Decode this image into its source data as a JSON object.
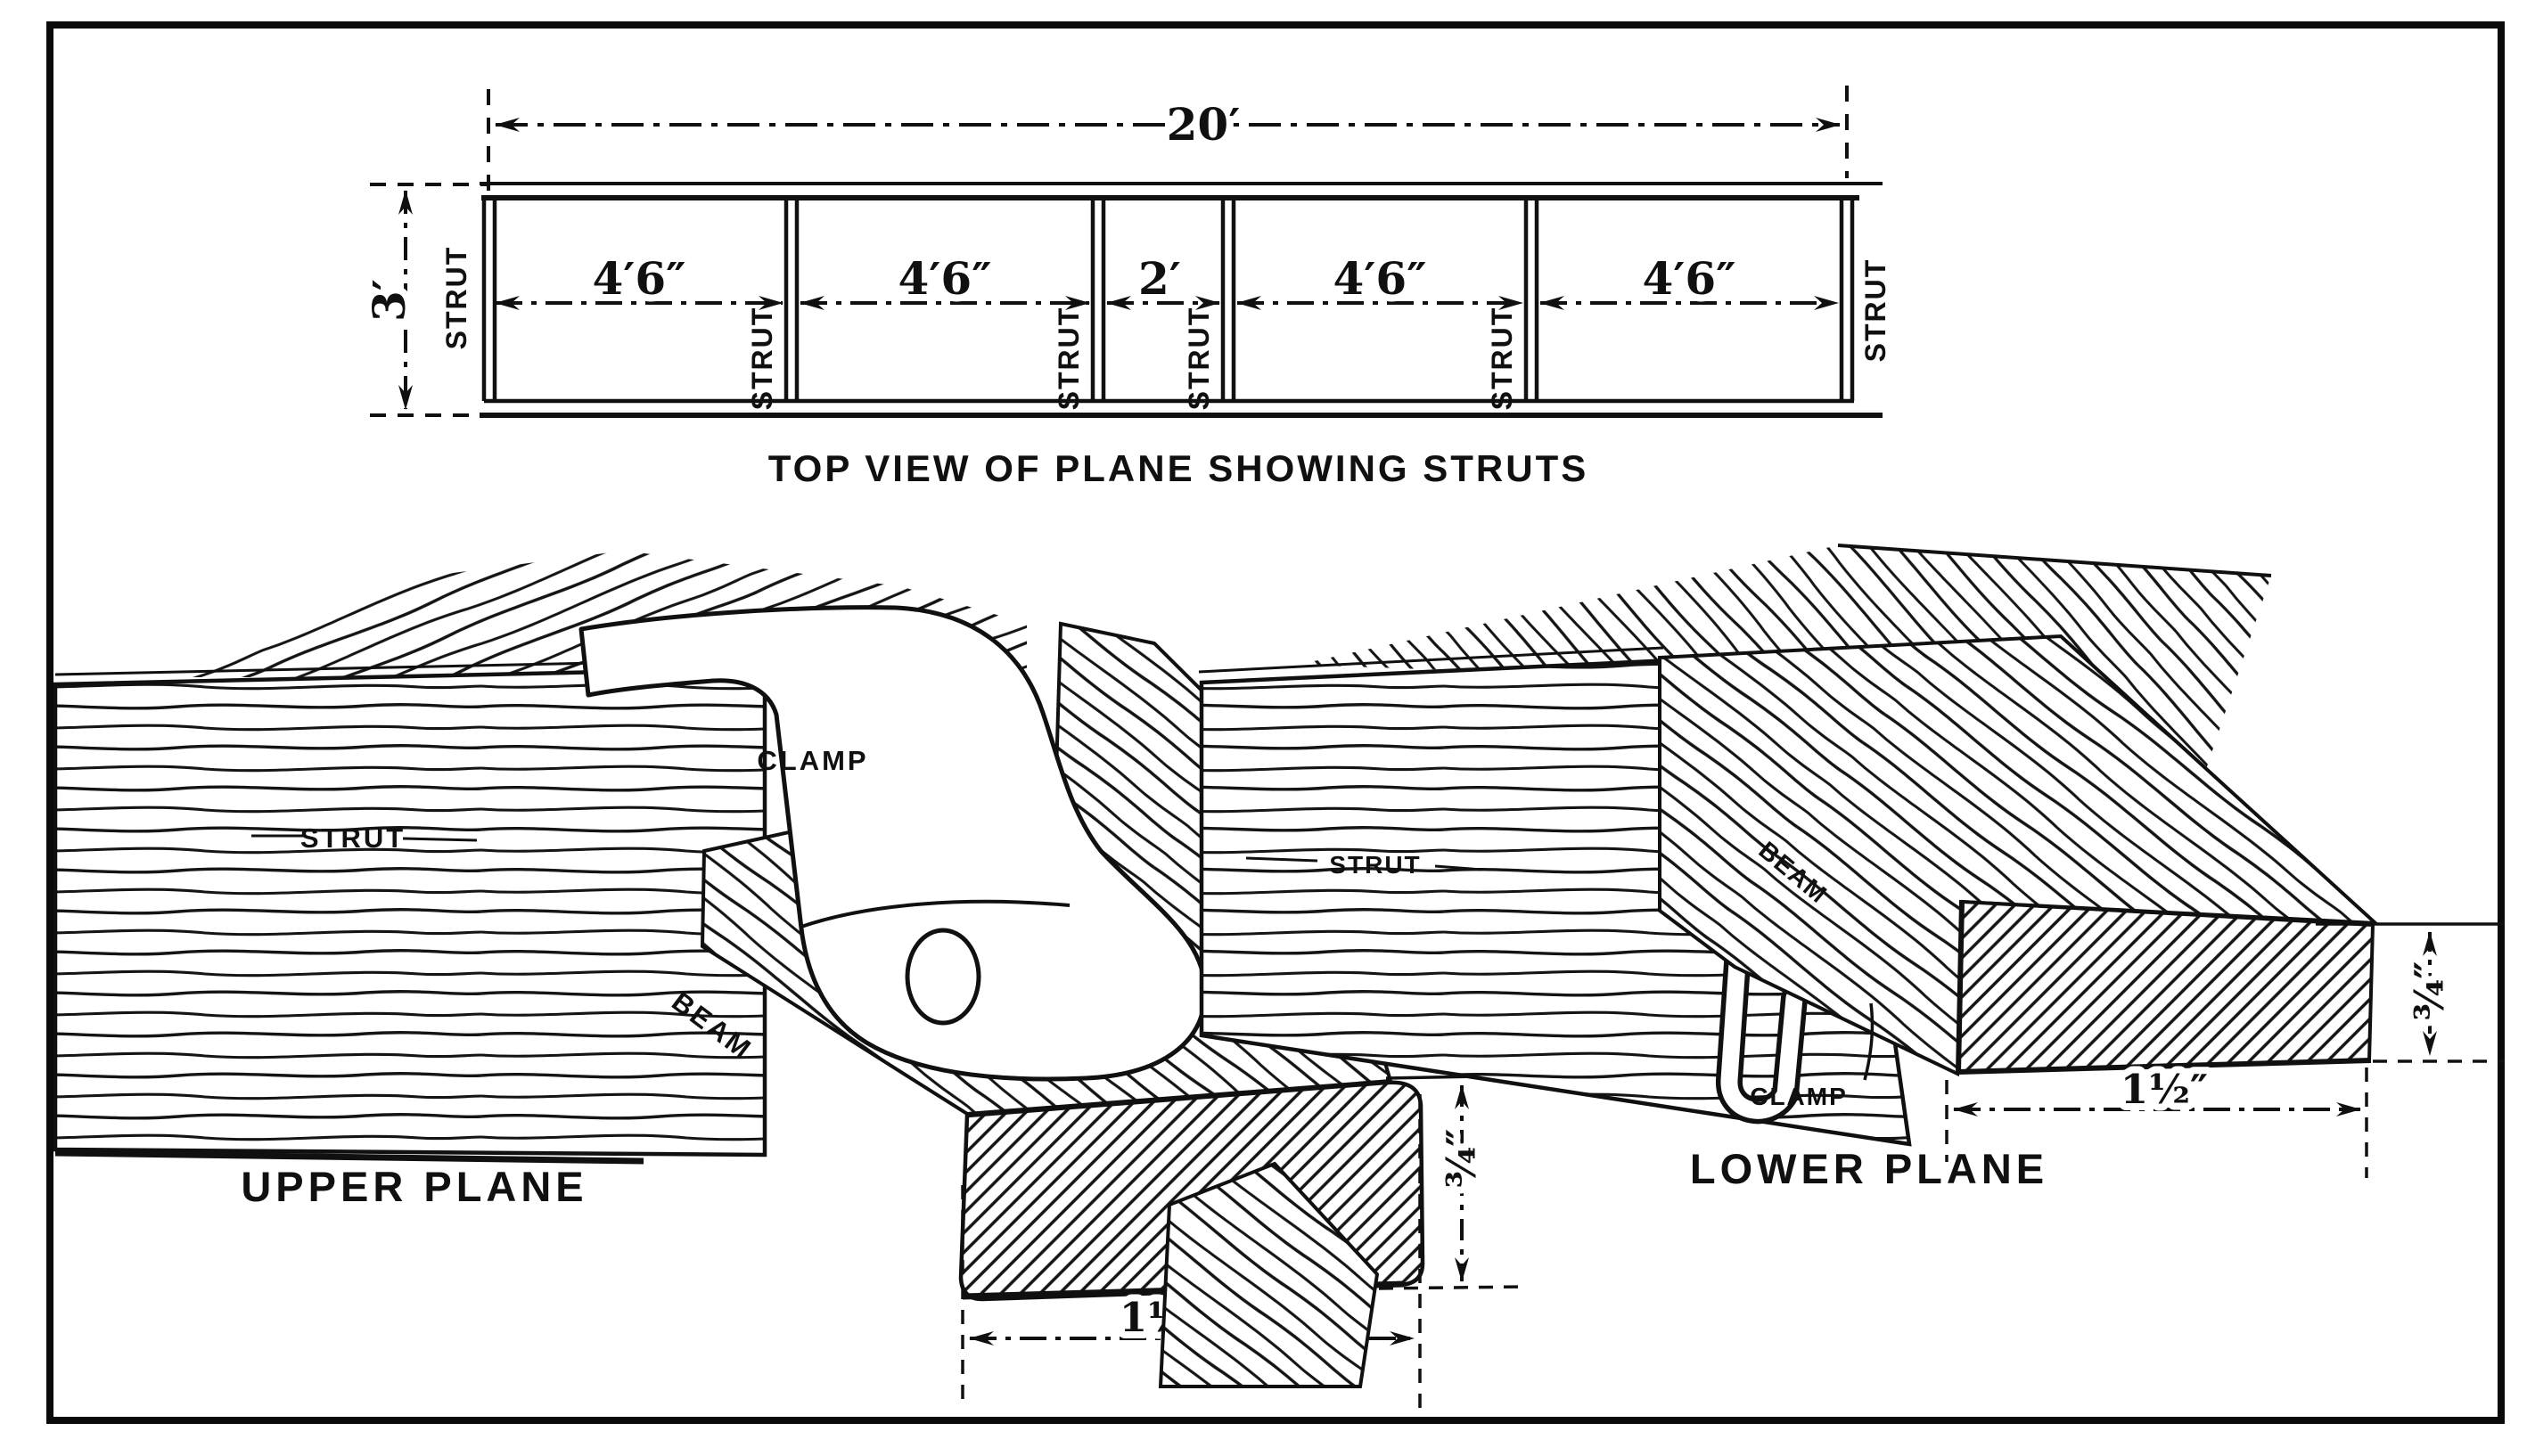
{
  "style": {
    "paper": "#ffffff",
    "ink": "#101010"
  },
  "figure": {
    "top_view": {
      "caption": "TOP VIEW OF PLANE SHOWING STRUTS",
      "overall_span": "20′",
      "chord_depth": "3′",
      "strut_label": "STRUT",
      "spans": [
        "4′6″",
        "4′6″",
        "2′",
        "4′6″",
        "4′6″"
      ]
    },
    "upper_detail": {
      "caption": "UPPER PLANE",
      "strut_label": "STRUT",
      "clamp_label": "CLAMP",
      "beam_label": "BEAM",
      "beam_width": "1½″",
      "beam_depth": "¾″"
    },
    "lower_detail": {
      "caption": "LOWER PLANE",
      "strut_label": "STRUT",
      "clamp_label": "CLAMP",
      "beam_label": "BEAM",
      "beam_width": "1½″",
      "beam_depth": "¾″"
    }
  }
}
